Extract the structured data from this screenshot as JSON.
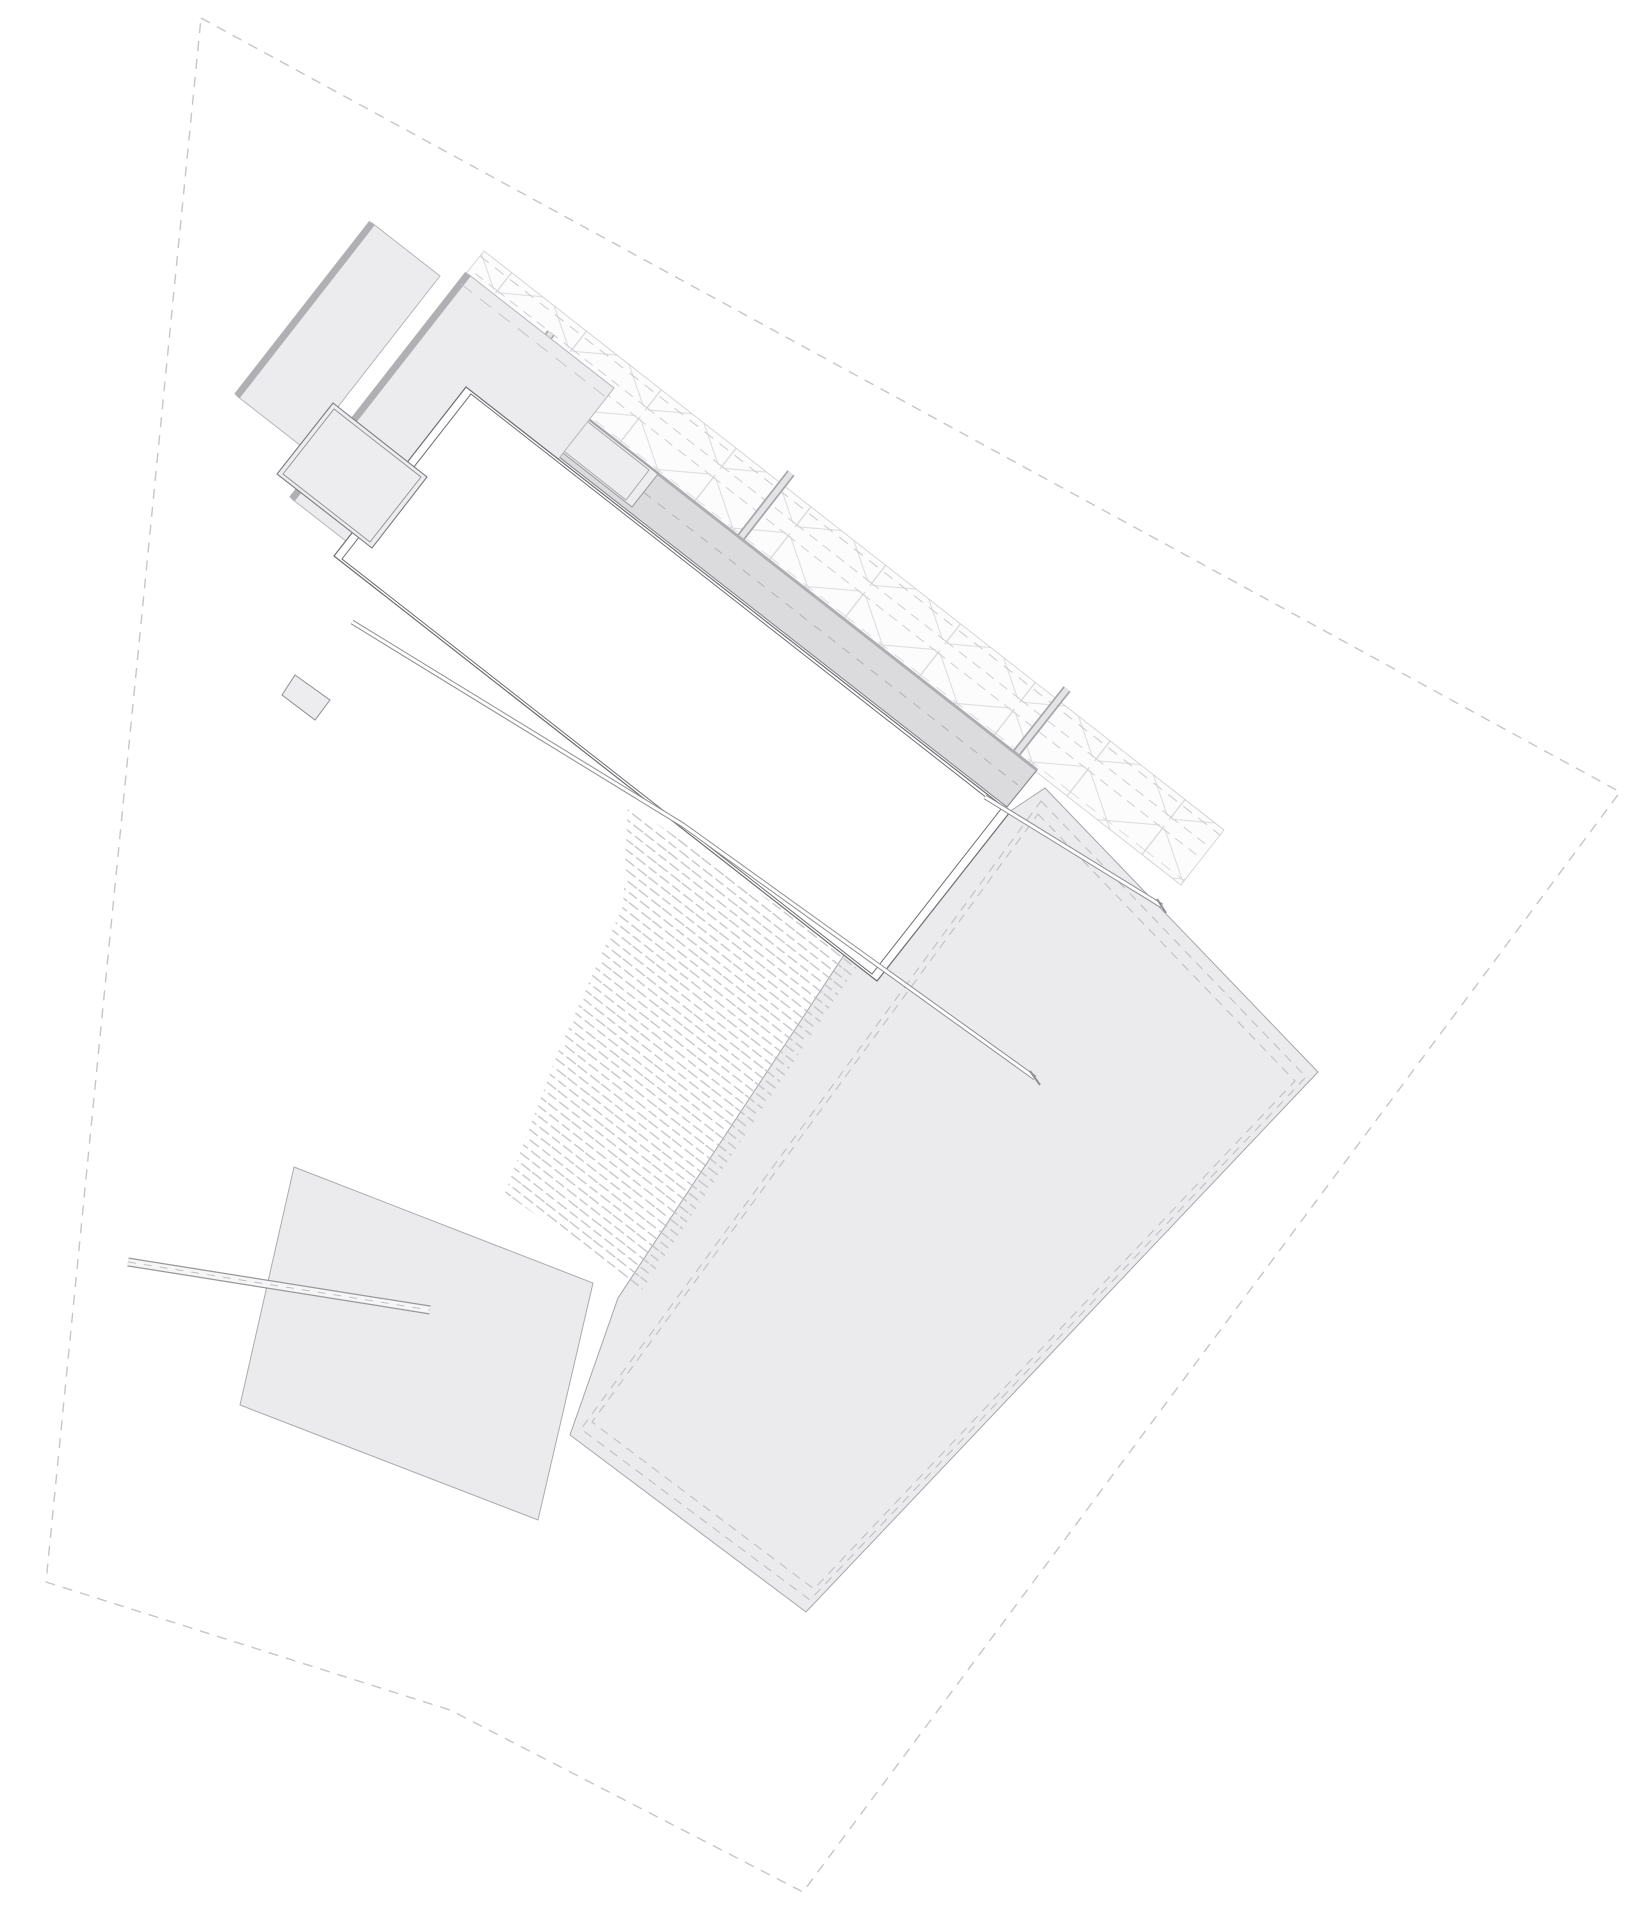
{
  "meta": {
    "type": "architectural-site-plan",
    "canvas_width": 1648,
    "canvas_height": 1920,
    "rotation_deg": 38,
    "visible_text": "none"
  },
  "palette": {
    "background": "#ffffff",
    "boundary_dash": "#c6c6ca",
    "light_fill": "#ececee",
    "field_fill": "#ebebed",
    "strip_fill": "#dbdbdd",
    "wall_line": "#6e6e72",
    "medium_line": "#96969a",
    "truss_line": "#d5d5d9",
    "brick_line": "#c2c2c6",
    "roof_edge": "#b0b0b4"
  },
  "boundary": {
    "points": "201,18 1620,792 803,1892 450,1710 46,1582"
  },
  "field": {
    "outline": "1045,788 1318,1072 806,1612 570,1435 618,1298 875,908 1000,818",
    "inset1": "1041,801 1306,1077 810,1600 581,1429",
    "inset2": "1038,814 1295,1081 814,1589 592,1422"
  },
  "plot2": {
    "outline": "294,1167 593,1283 538,1520 240,1405"
  },
  "road": {
    "line": "128,1262 430,1310"
  },
  "brick_area": {
    "outline": "628,804 860,962 642,1290 505,1193 558,1052 623,906"
  },
  "truss": {
    "band": "484,251 1224,830 1181,885 440,306",
    "edge_dash": "480,256 1220,835"
  },
  "bars": {
    "bar0": "514,380 551,333",
    "bar1": "731,550 791,473",
    "bar2": "1007,765 1067,689"
  },
  "strip": {
    "outline": "583,415 1037,770 1007,807 554,453",
    "ne_edge": "583,415 1037,770",
    "centerline": "573,437 1018,785"
  },
  "courtyard": {
    "outer": "485,392 632,507 658,474 511,359",
    "inner": "494,396 626,500 649,470 517,366"
  },
  "roof_back": {
    "outline": "372,223 440,276 305,449 237,396",
    "edge": "372,223 237,396"
  },
  "roof_main": {
    "outline": "468,274 614,388 438,613 292,499",
    "edge": "468,274 292,499",
    "dash": "461,284 607,398"
  },
  "hall": {
    "outer": "466,387 1010,812 877,981 334,556",
    "inner": "471,394 1001,809 872,974 342,559"
  },
  "annex": {
    "outer": "333,403 427,477 372,548 277,474",
    "inner": "334,409 421,477 370,542 283,474"
  },
  "stub": {
    "outline": "295,675 330,700 315,720 282,695"
  },
  "wall_a": {
    "path": "352,622 683,825 1035,1078",
    "cap": "1030,1071 1040,1085"
  },
  "wall_b": {
    "path": "985,797 1162,906",
    "cap": "1157,899 1166,913"
  }
}
